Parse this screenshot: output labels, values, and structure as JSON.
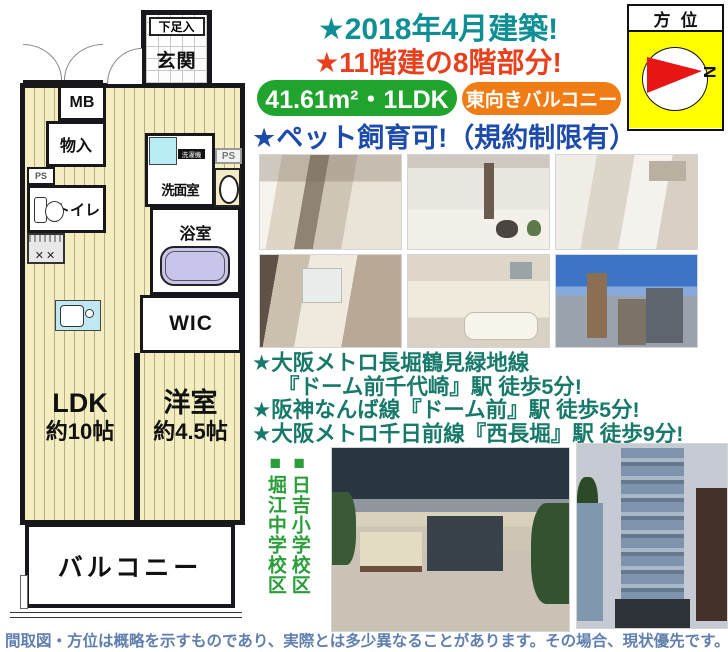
{
  "header": {
    "built": "★2018年4月建築!",
    "floors": "★11階建の8階部分!",
    "area_badge": "41.61m²・1LDK",
    "balcony_badge": "東向きバルコニー",
    "pet": "★ペット飼育可!（規約制限有）"
  },
  "compass": {
    "title": "方位",
    "north_mark": "N"
  },
  "floorplan": {
    "shoe_storage": "下足入",
    "entrance": "玄関",
    "meter_box": "MB",
    "storage": "物入",
    "pipe_space": "PS",
    "toilet": "トイレ",
    "washroom": "洗面室",
    "washer": "洗濯機",
    "bathroom": "浴室",
    "wic": "WIC",
    "ldk": "LDK",
    "ldk_size": "約10帖",
    "western_room": "洋室",
    "western_room_size": "約4.5帖",
    "balcony": "バルコニー"
  },
  "stations": {
    "line1": "★大阪メトロ長堀鶴見緑地線",
    "line2": "『ドーム前千代崎』駅 徒歩5分!",
    "line3": "★阪神なんば線『ドーム前』駅 徒歩5分!",
    "line4": "★大阪メトロ千日前線『西長堀』駅 徒歩9分!"
  },
  "schools": {
    "elementary": "■日吉小学校区",
    "junior_high": "■堀江中学校区"
  },
  "disclaimer": "間取図・方位は概略を示すものであり、実際とは多少異なることがあります。その場合、現状優先です。",
  "colors": {
    "built_teal": "#0e8f95",
    "floors_red": "#e8401c",
    "area_green": "#21a42e",
    "balcony_orange": "#f07c16",
    "pet_blue": "#1d4bab",
    "station_green": "#17796a",
    "school_green": "#2b9e3a",
    "disclaimer_blue": "#5f7fae",
    "compass_yellow": "#ffff00",
    "compass_red": "#e81515"
  }
}
